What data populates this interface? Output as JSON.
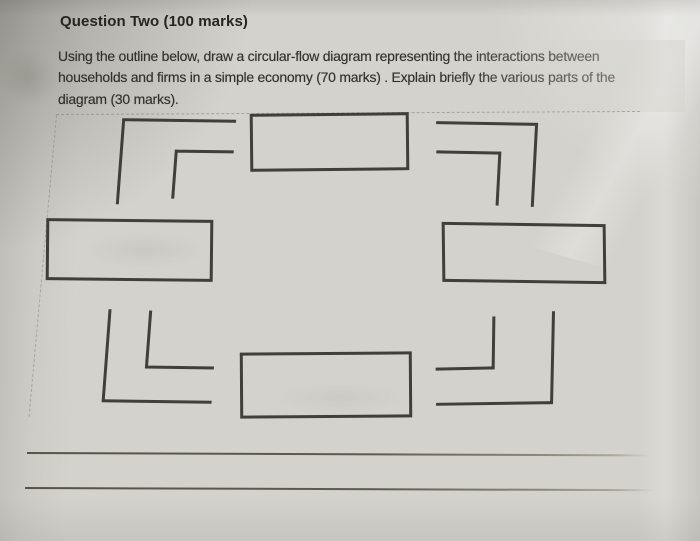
{
  "question": {
    "title": "Question Two (100 marks)",
    "body_lines": [
      "Using the outline below, draw a circular-flow diagram representing the interactions between",
      "households and firms in a simple economy (70 marks) . Explain briefly the various parts of the",
      "diagram (30 marks)."
    ]
  },
  "diagram": {
    "type": "blank circular-flow diagram outline",
    "boxes_count": 4,
    "corner_marks_count": 8,
    "answer_lines_count": 2
  },
  "colors": {
    "paper": "#d3d2cc",
    "ink": "#2c2a25",
    "rule_line": "#565449",
    "dashed_guide": "#7a786e"
  }
}
